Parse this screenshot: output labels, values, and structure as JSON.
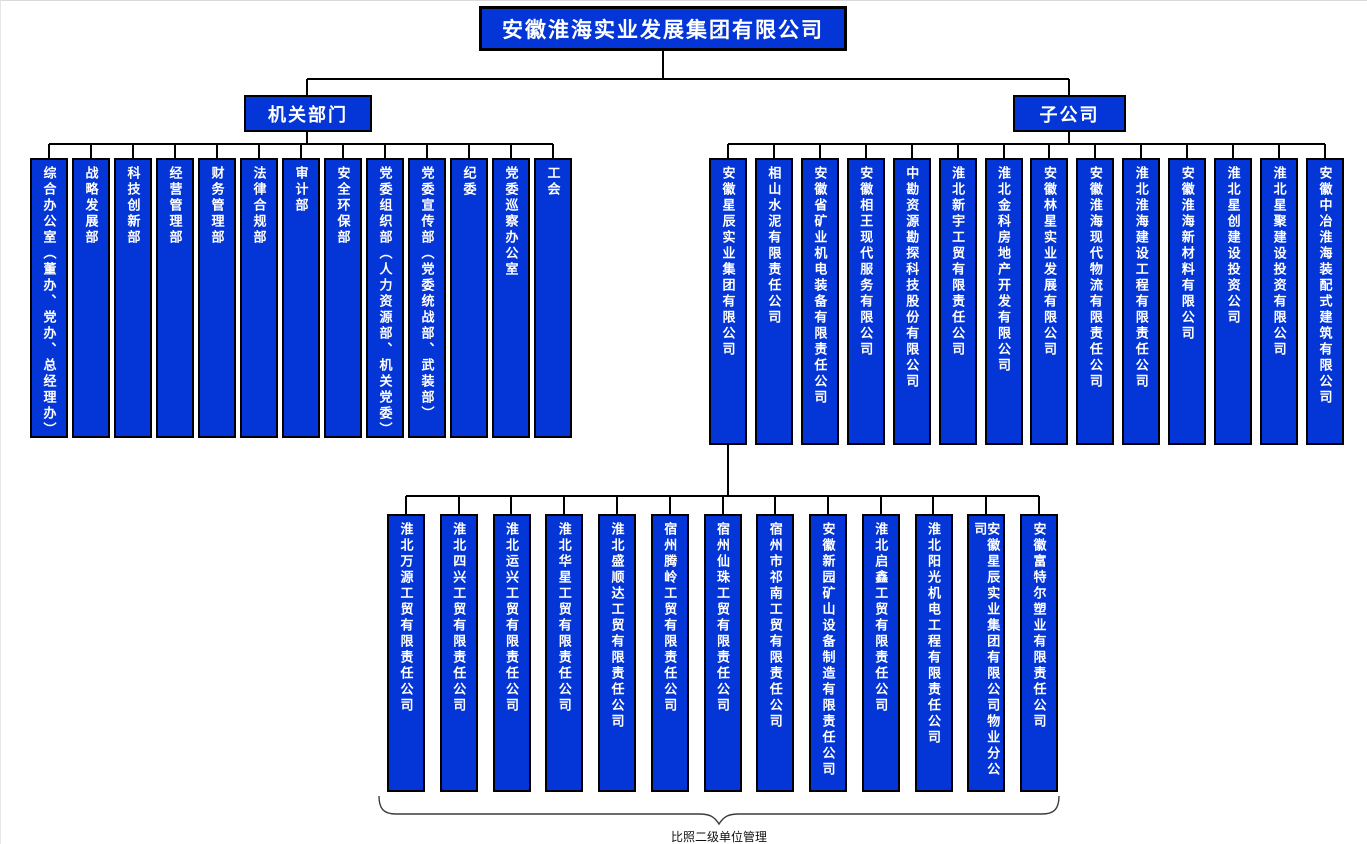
{
  "root": {
    "name": "安徽淮海实业发展集团有限公司"
  },
  "groups": {
    "departments": {
      "label": "机关部门",
      "items": [
        "综合办公室（董办、党办、总经理办）",
        "战略发展部",
        "科技创新部",
        "经营管理部",
        "财务管理部",
        "法律合规部",
        "审计部",
        "安全环保部",
        "党委组织部（人力资源部、机关党委）",
        "党委宣传部（党委统战部、武装部）",
        "纪委",
        "党委巡察办公室",
        "工会"
      ]
    },
    "subsidiaries": {
      "label": "子公司",
      "items": [
        "安徽星辰实业集团有限公司",
        "相山水泥有限责任公司",
        "安徽省矿业机电装备有限责任公司",
        "安徽相王现代服务有限公司",
        "中勘资源勘探科技股份有限公司",
        "淮北新宇工贸有限责任公司",
        "淮北金科房地产开发有限公司",
        "安徽林星实业发展有限公司",
        "安徽淮海现代物流有限责任公司",
        "淮北淮海建设工程有限责任公司",
        "安徽淮海新材料有限公司",
        "淮北星创建设投资公司",
        "淮北星聚建设投资有限公司",
        "安徽中冶淮海装配式建筑有限公司"
      ]
    }
  },
  "third_level": {
    "items": [
      "淮北万源工贸有限责任公司",
      "淮北四兴工贸有限责任公司",
      "淮北运兴工贸有限责任公司",
      "淮北华星工贸有限责任公司",
      "淮北盛顺达工贸有限责任公司",
      "宿州腾岭工贸有限责任公司",
      "宿州仙珠工贸有限责任公司",
      "宿州市祁南工贸有限责任公司",
      "安徽新园矿山设备制造有限责任公司",
      "淮北启鑫工贸有限责任公司",
      "淮北阳光机电工程有限责任公司",
      "安徽星辰实业集团有限公司物业分公司",
      "安徽富特尔塑业有限责任公司"
    ],
    "footnote": "比照二级单位管理"
  },
  "colors": {
    "node_fill": "#0435D6",
    "node_border": "#000000",
    "node_text": "#FFFFFF",
    "connector": "#000000",
    "brace": "#3C3C3C"
  }
}
